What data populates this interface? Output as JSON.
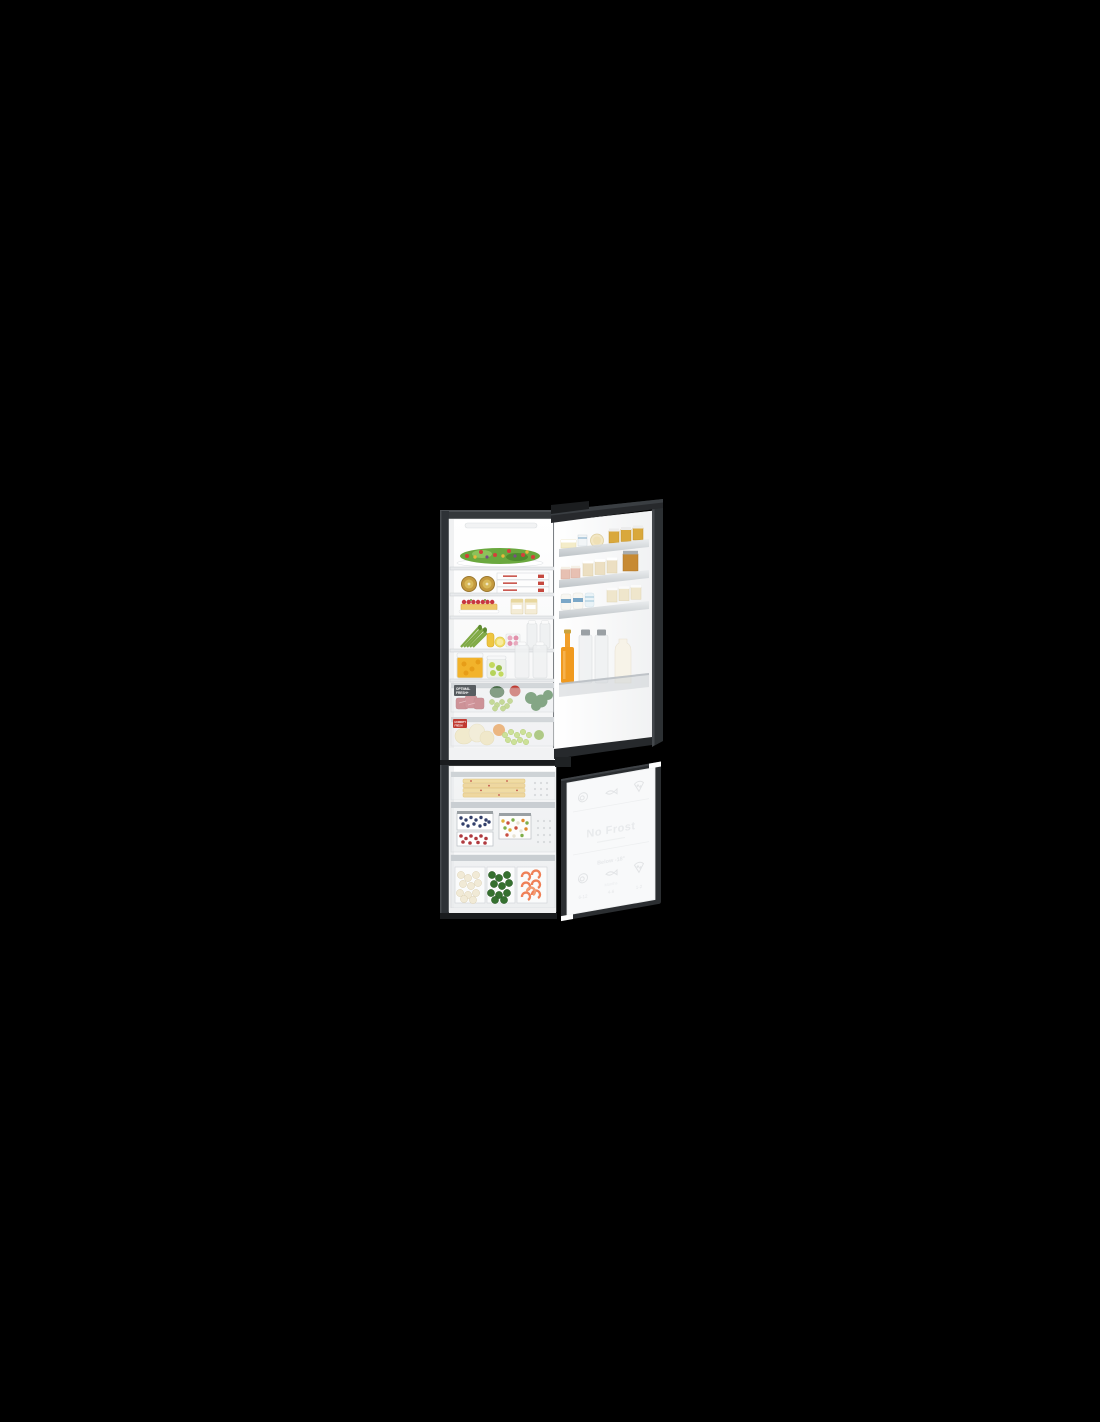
{
  "product": {
    "labels": {
      "optimal_fresh": {
        "line1": "OPTIMAL",
        "line2": "FRESH+"
      },
      "humidity_fresh": {
        "line1": "HUMIDITY",
        "line2": "FRESH"
      },
      "freezer_panel": {
        "no_frost": "No Frost",
        "below_temp": "Below -18°",
        "months": "Months",
        "ranges": [
          "6-12",
          "4-6",
          "1-2"
        ]
      }
    },
    "icons": [
      "meat-icon",
      "fish-icon",
      "pizza-icon"
    ],
    "colors": {
      "background": "#000000",
      "cabinet_dark": "#2e3236",
      "interior_white": "#f8f9fa",
      "shelf_gray": "#d8dcde",
      "juice_orange": "#f09a20",
      "tag_red": "#c13a31",
      "tag_gray": "#585d61"
    }
  }
}
